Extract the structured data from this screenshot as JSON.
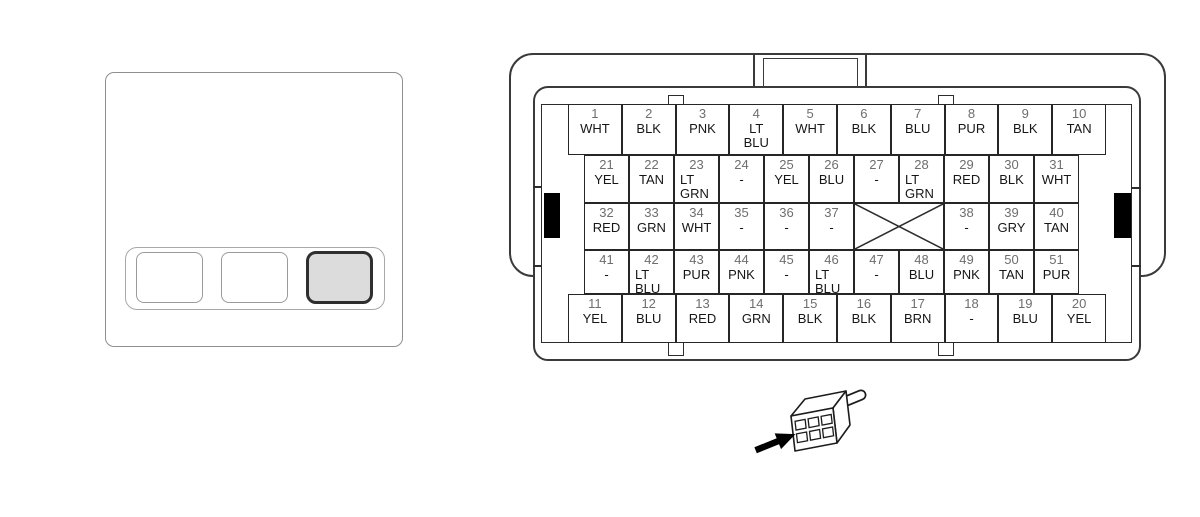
{
  "colors": {
    "background": "#ffffff",
    "line_dark": "#2d2d2d",
    "shell_line": "#3a3a3a",
    "pin_number_text": "#6e6e6e",
    "wire_color_text": "#161616",
    "module_line": "#8f8f8f",
    "latch_fill": "#000000",
    "highlight_slot_fill": "#dcdcdc"
  },
  "module": {
    "slots": [
      {
        "id": 1,
        "highlighted": false
      },
      {
        "id": 2,
        "highlighted": false
      },
      {
        "id": 3,
        "highlighted": true
      }
    ]
  },
  "connector": {
    "pin_rows": [
      {
        "cells": [
          {
            "pin": "1",
            "color": "WHT"
          },
          {
            "pin": "2",
            "color": "BLK"
          },
          {
            "pin": "3",
            "color": "PNK"
          },
          {
            "pin": "4",
            "color": "LT BLU"
          },
          {
            "pin": "5",
            "color": "WHT"
          },
          {
            "pin": "6",
            "color": "BLK"
          },
          {
            "pin": "7",
            "color": "BLU"
          },
          {
            "pin": "8",
            "color": "PUR"
          },
          {
            "pin": "9",
            "color": "BLK"
          },
          {
            "pin": "10",
            "color": "TAN"
          }
        ]
      },
      {
        "cells": [
          {
            "pin": "21",
            "color": "YEL"
          },
          {
            "pin": "22",
            "color": "TAN"
          },
          {
            "pin": "23",
            "color": "LT GRN"
          },
          {
            "pin": "24",
            "color": "-"
          },
          {
            "pin": "25",
            "color": "YEL"
          },
          {
            "pin": "26",
            "color": "BLU"
          },
          {
            "pin": "27",
            "color": "-"
          },
          {
            "pin": "28",
            "color": "LT GRN"
          },
          {
            "pin": "29",
            "color": "RED"
          },
          {
            "pin": "30",
            "color": "BLK"
          },
          {
            "pin": "31",
            "color": "WHT"
          }
        ]
      },
      {
        "cells": [
          {
            "pin": "32",
            "color": "RED"
          },
          {
            "pin": "33",
            "color": "GRN"
          },
          {
            "pin": "34",
            "color": "WHT"
          },
          {
            "pin": "35",
            "color": "-"
          },
          {
            "pin": "36",
            "color": "-"
          },
          {
            "pin": "37",
            "color": "-"
          },
          {
            "crossed": true,
            "span": 2
          },
          {
            "pin": "38",
            "color": "-"
          },
          {
            "pin": "39",
            "color": "GRY"
          },
          {
            "pin": "40",
            "color": "TAN"
          }
        ]
      },
      {
        "cells": [
          {
            "pin": "41",
            "color": "-"
          },
          {
            "pin": "42",
            "color": "LT BLU"
          },
          {
            "pin": "43",
            "color": "PUR"
          },
          {
            "pin": "44",
            "color": "PNK"
          },
          {
            "pin": "45",
            "color": "-"
          },
          {
            "pin": "46",
            "color": "LT BLU"
          },
          {
            "pin": "47",
            "color": "-"
          },
          {
            "pin": "48",
            "color": "BLU"
          },
          {
            "pin": "49",
            "color": "PNK"
          },
          {
            "pin": "50",
            "color": "TAN"
          },
          {
            "pin": "51",
            "color": "PUR"
          }
        ]
      },
      {
        "cells": [
          {
            "pin": "11",
            "color": "YEL"
          },
          {
            "pin": "12",
            "color": "BLU"
          },
          {
            "pin": "13",
            "color": "RED"
          },
          {
            "pin": "14",
            "color": "GRN"
          },
          {
            "pin": "15",
            "color": "BLK"
          },
          {
            "pin": "16",
            "color": "BLK"
          },
          {
            "pin": "17",
            "color": "BRN"
          },
          {
            "pin": "18",
            "color": "-"
          },
          {
            "pin": "19",
            "color": "BLU"
          },
          {
            "pin": "20",
            "color": "YEL"
          }
        ]
      }
    ]
  },
  "icons": [
    {
      "name": "arrow-icon"
    },
    {
      "name": "plug-icon"
    },
    {
      "name": "crossed-out-icon"
    }
  ]
}
